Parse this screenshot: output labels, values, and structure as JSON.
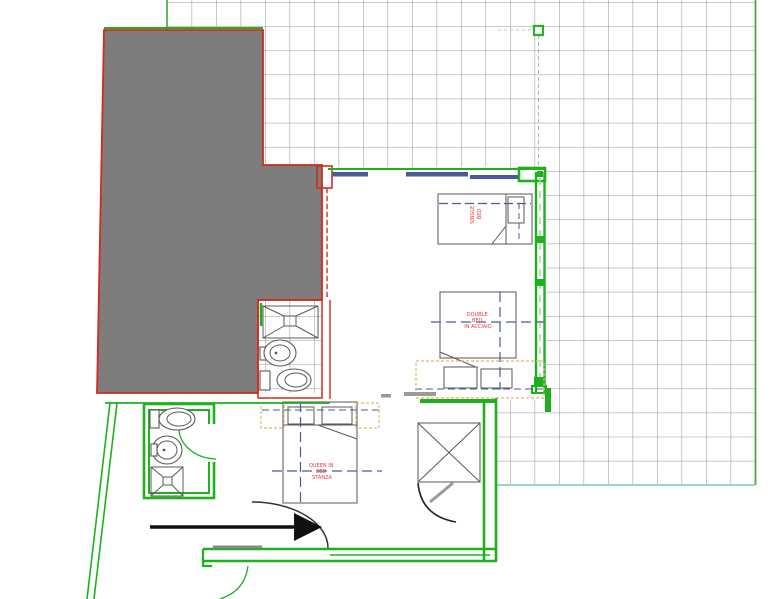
{
  "drawing": {
    "type": "floor-plan",
    "labels": {
      "bed_single": {
        "line1": "SINGLE",
        "line2": "BED"
      },
      "bed_double": {
        "line1": "DOUBLE",
        "line2": "BED",
        "line3": "IN ACCIAIO"
      },
      "bed_queen": {
        "line1": "QUEEN IN",
        "line2": "BED",
        "line3": "STANZA"
      }
    }
  },
  "colors": {
    "wall_green": "#1db21d",
    "grid_green": "#3fae3f",
    "grid_gray": "#a8a8a8",
    "outline_red": "#d42a1e",
    "building_gray": "#7d7d7d",
    "window_navy": "#4c5a96",
    "accent_orange": "#e8b568",
    "label_red": "#e03c3c",
    "arrow_black": "#111111",
    "door_gray": "#888888"
  }
}
